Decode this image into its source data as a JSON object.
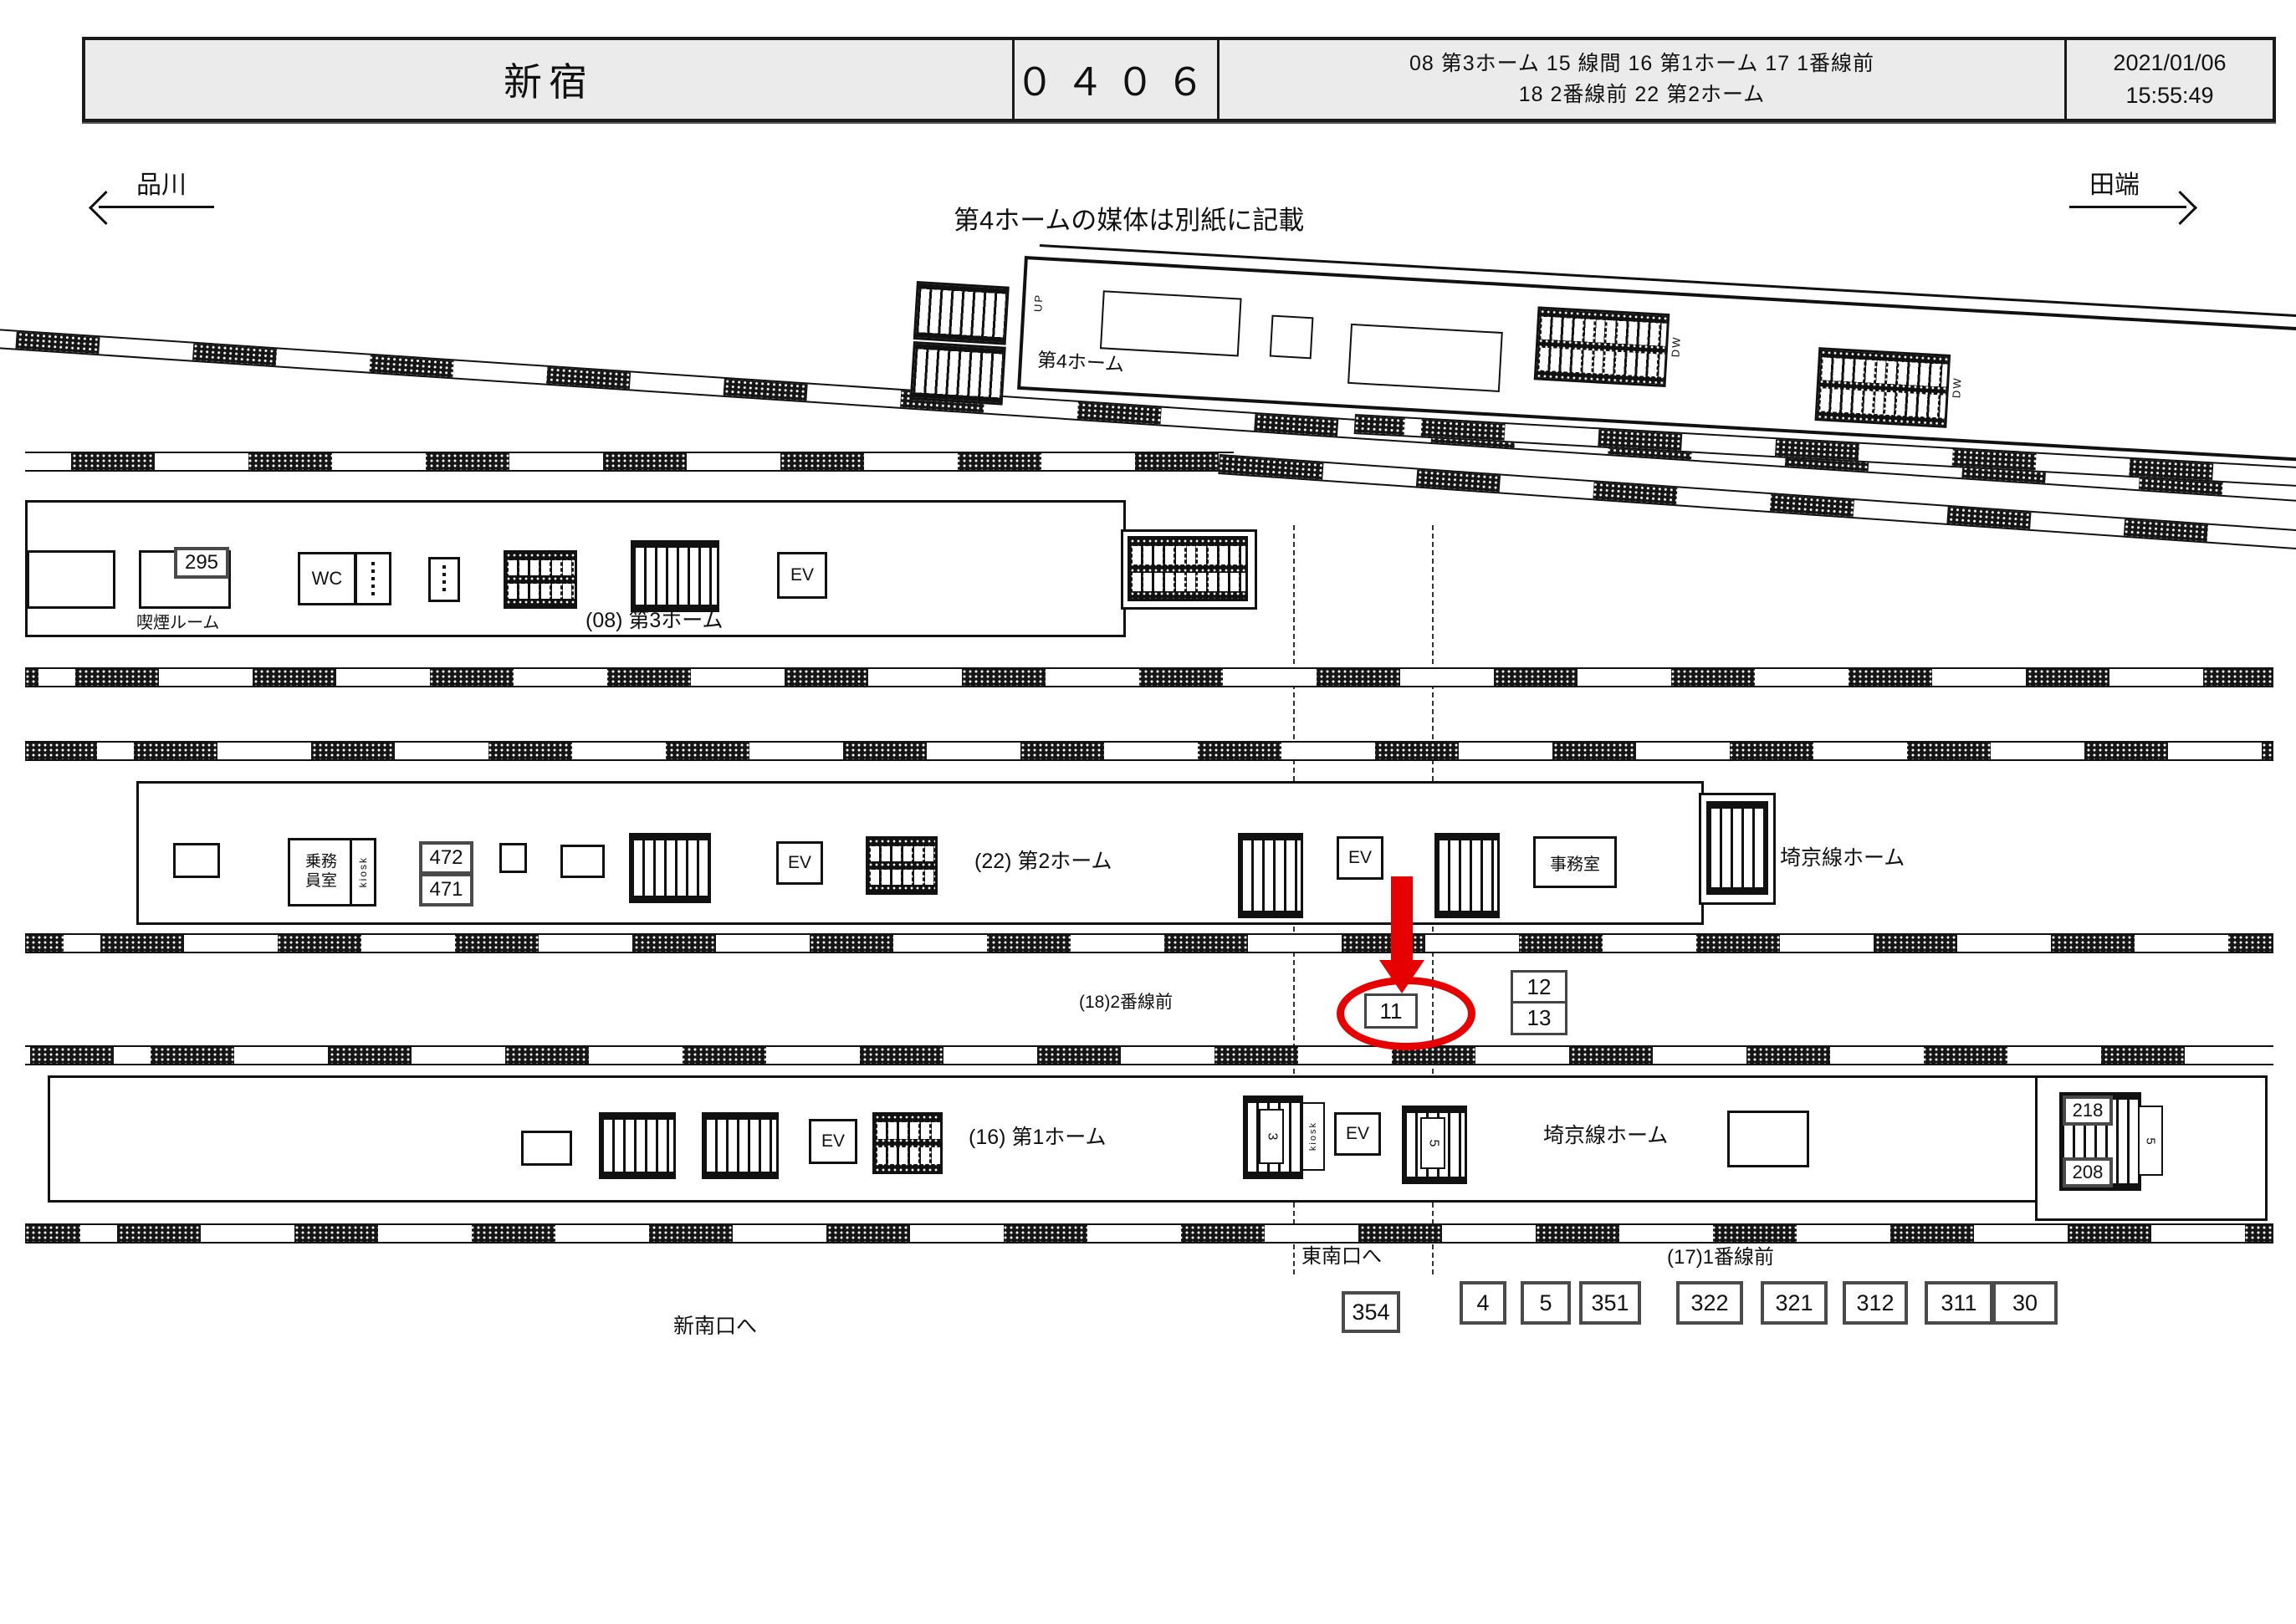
{
  "header": {
    "station": "新宿",
    "code": "０４０６",
    "media_line1": "08 第3ホーム  15 線間  16 第1ホーム  17 1番線前",
    "media_line2": "18 2番線前  22 第2ホーム",
    "date": "2021/01/06",
    "time": "15:55:49"
  },
  "directions": {
    "left": "品川",
    "right": "田端"
  },
  "note": "第4ホームの媒体は別紙に記載",
  "shared": {
    "ev": "EV",
    "kiosk": "kiosk",
    "up": "UP",
    "dw": "DW"
  },
  "platform4": {
    "label": "第4ホーム"
  },
  "platform3": {
    "label": "(08) 第3ホーム",
    "smoking_room": "喫煙ルーム",
    "badge_295": "295",
    "wc": "WC"
  },
  "platform2": {
    "label": "(22) 第2ホーム",
    "crew_line1": "乗務",
    "crew_line2": "員室",
    "badge_472": "472",
    "badge_471": "471",
    "office": "事務室",
    "saikyo": "埼京線ホーム"
  },
  "row18": {
    "label": "(18)2番線前",
    "badge_11": "11",
    "badge_12": "12",
    "badge_13": "13"
  },
  "platform1": {
    "label": "(16) 第1ホーム",
    "stair_3": "3",
    "stair_5": "5",
    "badge_218": "218",
    "badge_208": "208",
    "saikyo": "埼京線ホーム"
  },
  "bottom": {
    "tonan": "東南口へ",
    "shinnan": "新南口へ",
    "badge_354": "354",
    "line17_label": "(17)1番線前",
    "badges": [
      "4",
      "5",
      "351",
      "322",
      "321",
      "312",
      "311",
      "30"
    ]
  },
  "colors": {
    "highlight_red": "#e60000",
    "header_bg": "#ebebeb"
  }
}
